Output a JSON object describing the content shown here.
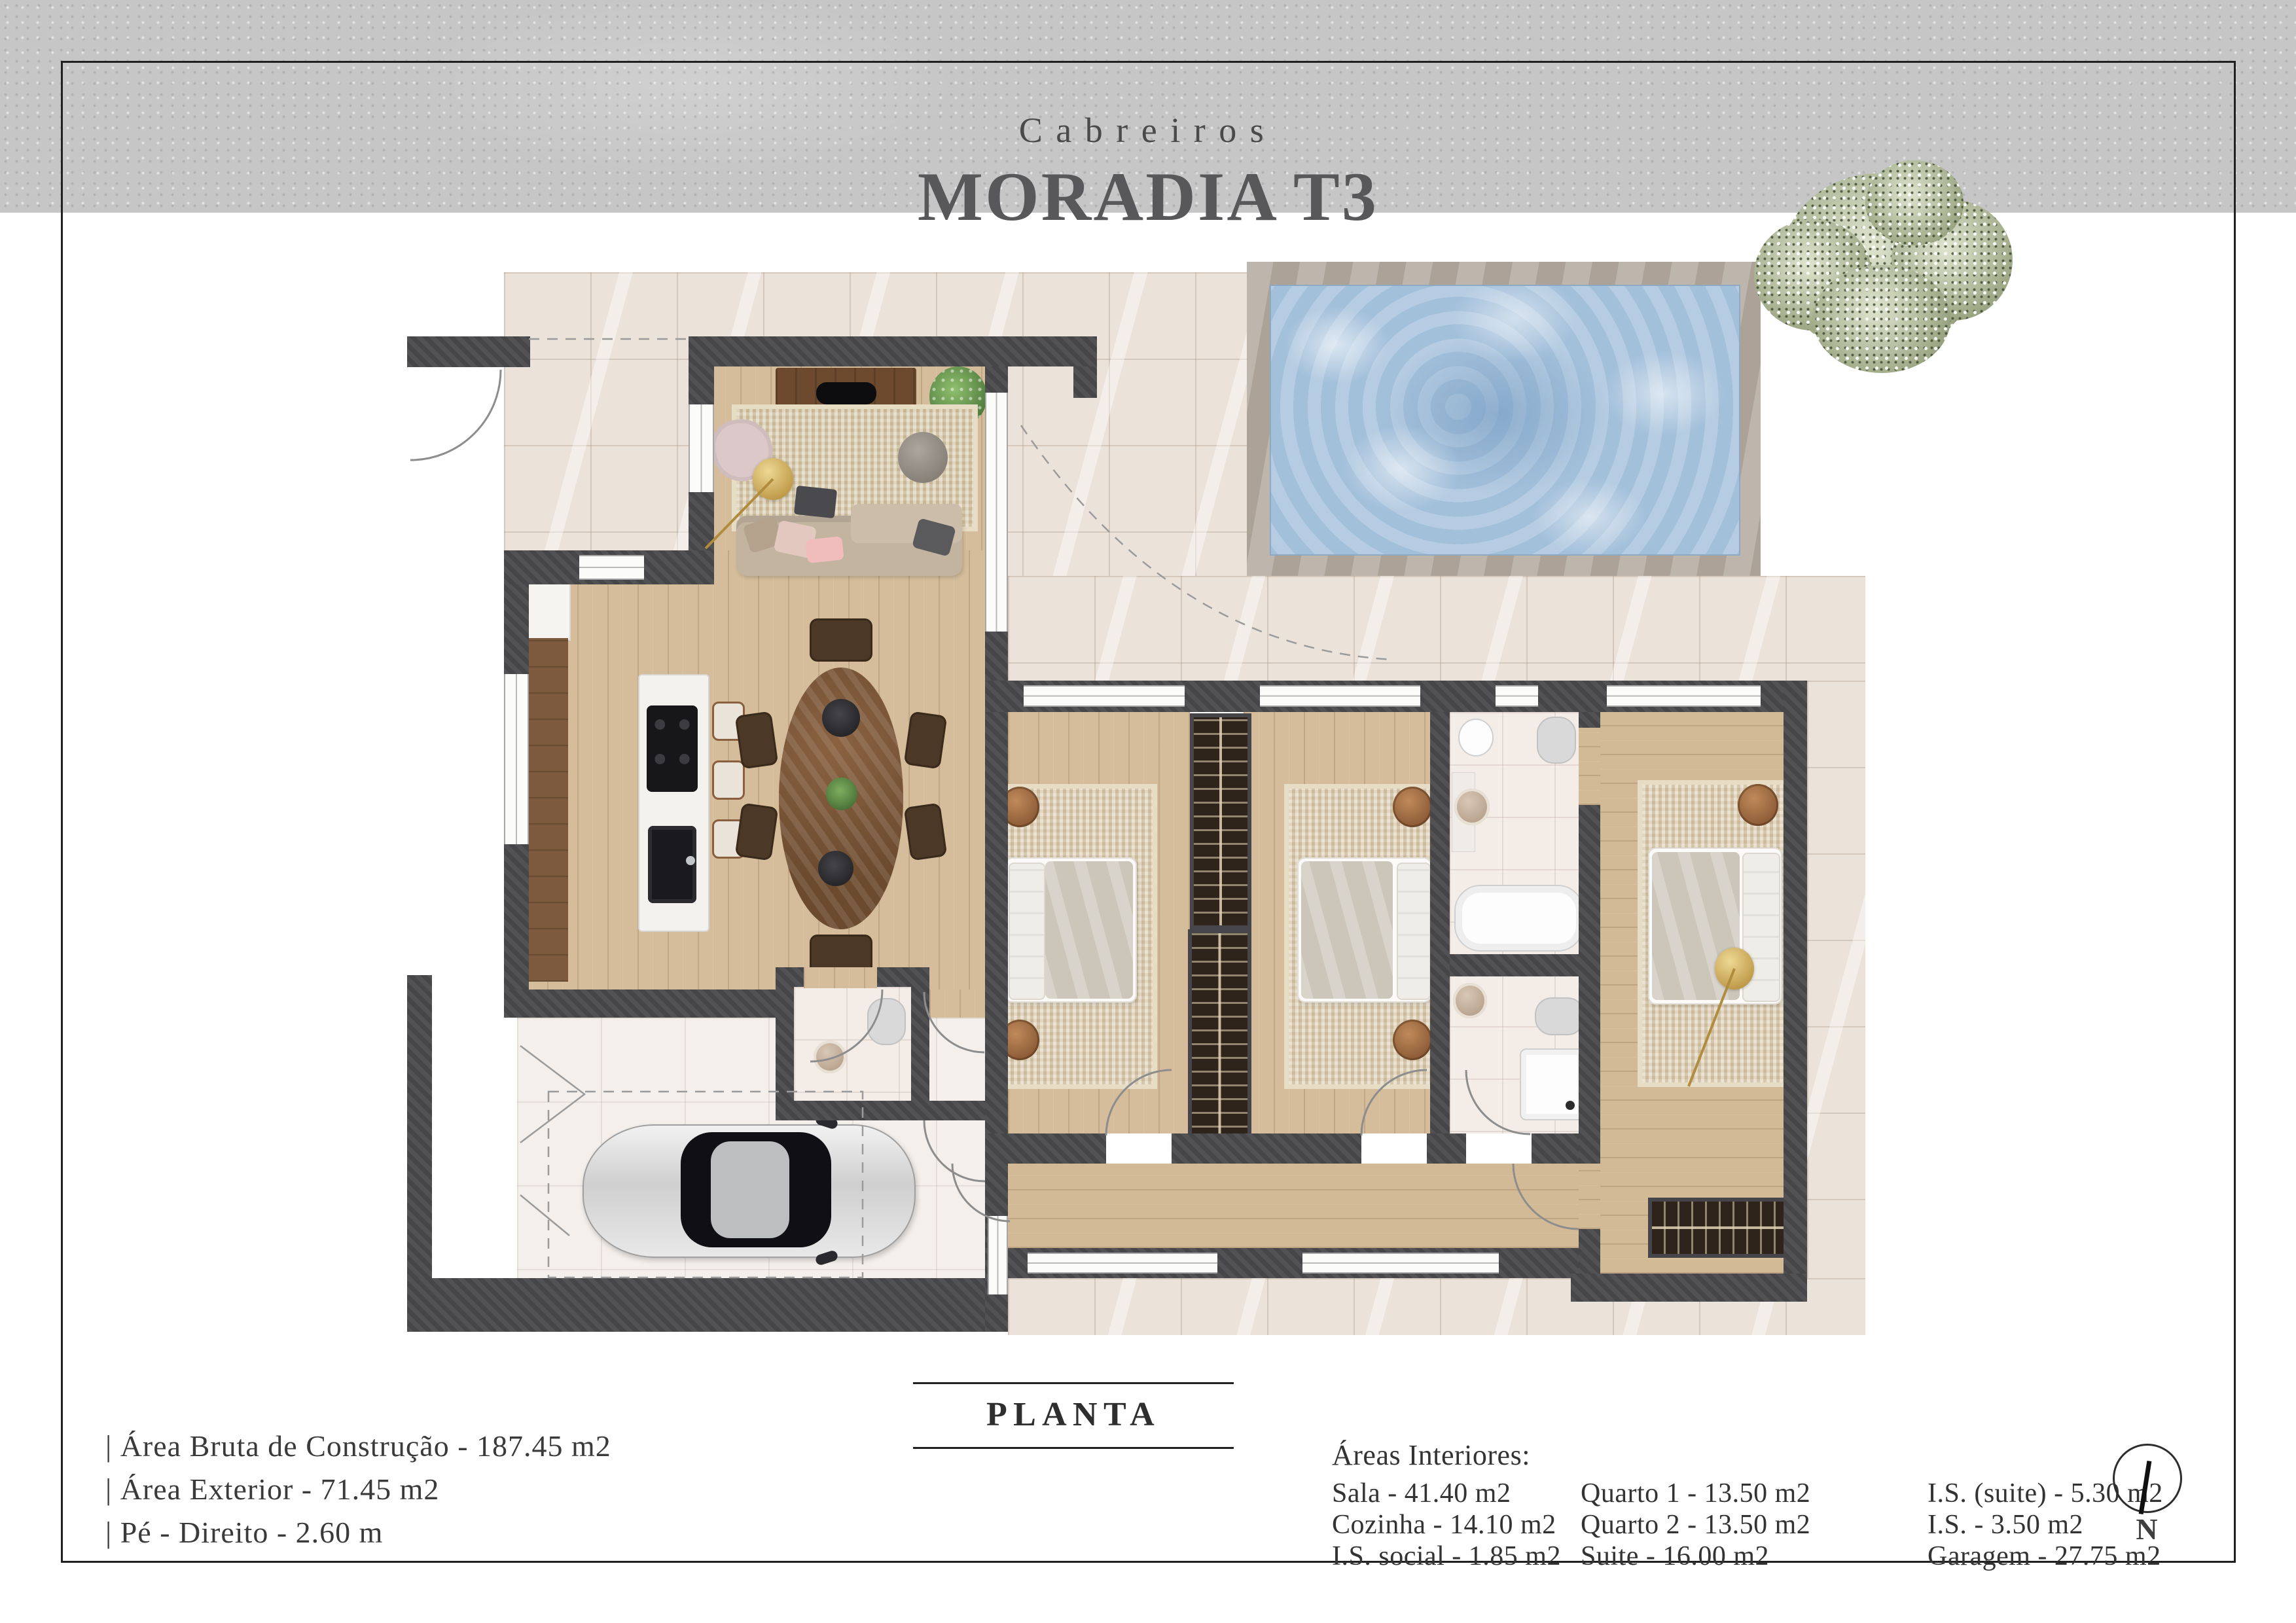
{
  "header": {
    "estate": "Cabreiros",
    "title": "MORADIA T3"
  },
  "plan": {
    "label": "PLANTA"
  },
  "stats": {
    "lines": [
      "| Área Bruta de Construção - 187.45 m2",
      "| Área Exterior - 71.45 m2",
      "| Pé - Direito - 2.60 m"
    ]
  },
  "areas": {
    "heading": "Áreas Interiores:",
    "col1": [
      "Sala - 41.40 m2",
      "Cozinha - 14.10 m2",
      "I.S. social - 1.85 m2"
    ],
    "col2": [
      "Quarto 1 - 13.50 m2",
      "Quarto 2 - 13.50 m2",
      "Suite - 16.00 m2"
    ],
    "col3": [
      "I.S. (suite) - 5.30 m2",
      "I.S. - 3.50 m2",
      "Garagem - 27.75 m2"
    ]
  },
  "compass": {
    "label": "N"
  },
  "colors": {
    "wall": "#4a4a4d",
    "wood_floor": "#d5bd9b",
    "exterior_tile": "#ebe3da",
    "pool_water": "#a9c4dd",
    "pool_deck": "#b5aba0",
    "concrete_band": "#c6c6c6",
    "title_text": "#58585b"
  }
}
